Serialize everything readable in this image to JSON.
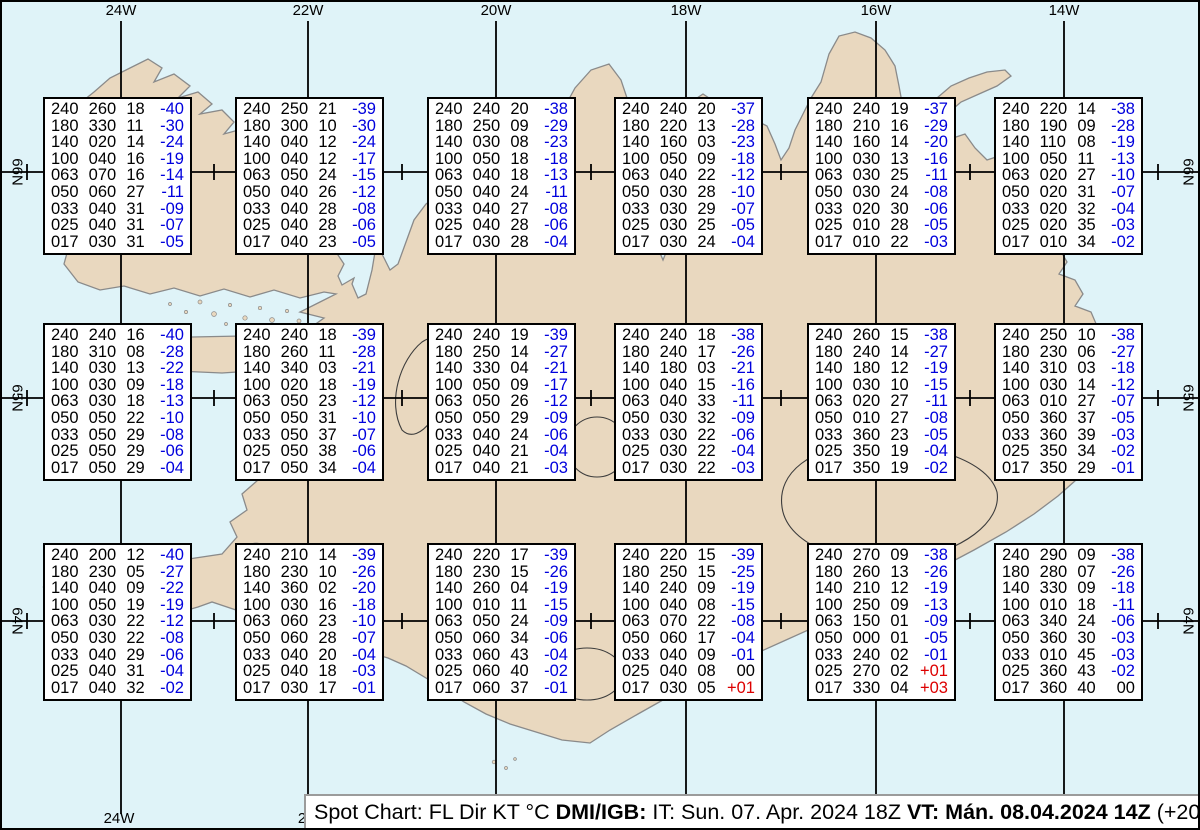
{
  "colors": {
    "sea": "#dff3f8",
    "land": "#e9d8bf",
    "coast": "#8a8a8a",
    "grid": "#000000",
    "temp_negative": "#0000dd",
    "temp_positive": "#dd0000",
    "text": "#000000"
  },
  "grid": {
    "lon_lines": [
      {
        "label": "24W",
        "x": 119
      },
      {
        "label": "22W",
        "x": 306
      },
      {
        "label": "20W",
        "x": 494
      },
      {
        "label": "18W",
        "x": 684
      },
      {
        "label": "16W",
        "x": 874
      },
      {
        "label": "14W",
        "x": 1062
      }
    ],
    "lat_lines": [
      {
        "label": "66N",
        "y": 170
      },
      {
        "label": "65N",
        "y": 396
      },
      {
        "label": "64N",
        "y": 619
      }
    ],
    "minor_tick_xs": [
      25,
      212,
      400,
      589,
      779,
      968,
      1156
    ],
    "bottom_labels": [
      {
        "text": "24W",
        "x": 117
      },
      {
        "text": "2",
        "x": 300
      }
    ],
    "lat_label_left_x": 15,
    "lat_label_right_x": 1186
  },
  "stations": [
    {
      "x": 41,
      "y": 95,
      "rows": [
        [
          "240",
          "260",
          "18",
          "-40"
        ],
        [
          "180",
          "330",
          "11",
          "-30"
        ],
        [
          "140",
          "020",
          "14",
          "-24"
        ],
        [
          "100",
          "040",
          "16",
          "-19"
        ],
        [
          "063",
          "070",
          "16",
          "-14"
        ],
        [
          "050",
          "060",
          "27",
          "-11"
        ],
        [
          "033",
          "040",
          "31",
          "-09"
        ],
        [
          "025",
          "040",
          "31",
          "-07"
        ],
        [
          "017",
          "030",
          "31",
          "-05"
        ]
      ]
    },
    {
      "x": 233,
      "y": 95,
      "rows": [
        [
          "240",
          "250",
          "21",
          "-39"
        ],
        [
          "180",
          "300",
          "10",
          "-30"
        ],
        [
          "140",
          "040",
          "12",
          "-24"
        ],
        [
          "100",
          "040",
          "12",
          "-17"
        ],
        [
          "063",
          "050",
          "24",
          "-15"
        ],
        [
          "050",
          "040",
          "26",
          "-12"
        ],
        [
          "033",
          "040",
          "28",
          "-08"
        ],
        [
          "025",
          "040",
          "28",
          "-06"
        ],
        [
          "017",
          "040",
          "23",
          "-05"
        ]
      ]
    },
    {
      "x": 425,
      "y": 95,
      "rows": [
        [
          "240",
          "240",
          "20",
          "-38"
        ],
        [
          "180",
          "250",
          "09",
          "-29"
        ],
        [
          "140",
          "030",
          "08",
          "-23"
        ],
        [
          "100",
          "050",
          "18",
          "-18"
        ],
        [
          "063",
          "040",
          "18",
          "-13"
        ],
        [
          "050",
          "040",
          "24",
          "-11"
        ],
        [
          "033",
          "040",
          "27",
          "-08"
        ],
        [
          "025",
          "040",
          "28",
          "-06"
        ],
        [
          "017",
          "030",
          "28",
          "-04"
        ]
      ]
    },
    {
      "x": 612,
      "y": 95,
      "rows": [
        [
          "240",
          "240",
          "20",
          "-37"
        ],
        [
          "180",
          "220",
          "13",
          "-28"
        ],
        [
          "140",
          "160",
          "03",
          "-23"
        ],
        [
          "100",
          "050",
          "09",
          "-18"
        ],
        [
          "063",
          "040",
          "22",
          "-12"
        ],
        [
          "050",
          "030",
          "28",
          "-10"
        ],
        [
          "033",
          "030",
          "29",
          "-07"
        ],
        [
          "025",
          "030",
          "25",
          "-05"
        ],
        [
          "017",
          "030",
          "24",
          "-04"
        ]
      ]
    },
    {
      "x": 805,
      "y": 95,
      "rows": [
        [
          "240",
          "240",
          "19",
          "-37"
        ],
        [
          "180",
          "210",
          "16",
          "-29"
        ],
        [
          "140",
          "160",
          "14",
          "-20"
        ],
        [
          "100",
          "030",
          "13",
          "-16"
        ],
        [
          "063",
          "030",
          "25",
          "-11"
        ],
        [
          "050",
          "030",
          "24",
          "-08"
        ],
        [
          "033",
          "020",
          "30",
          "-06"
        ],
        [
          "025",
          "010",
          "28",
          "-05"
        ],
        [
          "017",
          "010",
          "22",
          "-03"
        ]
      ]
    },
    {
      "x": 992,
      "y": 95,
      "rows": [
        [
          "240",
          "220",
          "14",
          "-38"
        ],
        [
          "180",
          "190",
          "09",
          "-28"
        ],
        [
          "140",
          "110",
          "08",
          "-19"
        ],
        [
          "100",
          "050",
          "11",
          "-13"
        ],
        [
          "063",
          "020",
          "27",
          "-10"
        ],
        [
          "050",
          "020",
          "31",
          "-07"
        ],
        [
          "033",
          "020",
          "32",
          "-04"
        ],
        [
          "025",
          "020",
          "35",
          "-03"
        ],
        [
          "017",
          "010",
          "34",
          "-02"
        ]
      ]
    },
    {
      "x": 41,
      "y": 321,
      "rows": [
        [
          "240",
          "240",
          "16",
          "-40"
        ],
        [
          "180",
          "310",
          "08",
          "-28"
        ],
        [
          "140",
          "030",
          "13",
          "-22"
        ],
        [
          "100",
          "030",
          "09",
          "-18"
        ],
        [
          "063",
          "030",
          "18",
          "-13"
        ],
        [
          "050",
          "050",
          "22",
          "-10"
        ],
        [
          "033",
          "050",
          "29",
          "-08"
        ],
        [
          "025",
          "050",
          "29",
          "-06"
        ],
        [
          "017",
          "050",
          "29",
          "-04"
        ]
      ]
    },
    {
      "x": 233,
      "y": 321,
      "rows": [
        [
          "240",
          "240",
          "18",
          "-39"
        ],
        [
          "180",
          "260",
          "11",
          "-28"
        ],
        [
          "140",
          "340",
          "03",
          "-21"
        ],
        [
          "100",
          "020",
          "18",
          "-19"
        ],
        [
          "063",
          "050",
          "23",
          "-12"
        ],
        [
          "050",
          "050",
          "31",
          "-10"
        ],
        [
          "033",
          "050",
          "37",
          "-07"
        ],
        [
          "025",
          "050",
          "38",
          "-06"
        ],
        [
          "017",
          "050",
          "34",
          "-04"
        ]
      ]
    },
    {
      "x": 425,
      "y": 321,
      "rows": [
        [
          "240",
          "240",
          "19",
          "-39"
        ],
        [
          "180",
          "250",
          "14",
          "-27"
        ],
        [
          "140",
          "330",
          "04",
          "-21"
        ],
        [
          "100",
          "050",
          "09",
          "-17"
        ],
        [
          "063",
          "050",
          "26",
          "-12"
        ],
        [
          "050",
          "050",
          "29",
          "-09"
        ],
        [
          "033",
          "040",
          "24",
          "-06"
        ],
        [
          "025",
          "040",
          "21",
          "-04"
        ],
        [
          "017",
          "040",
          "21",
          "-03"
        ]
      ]
    },
    {
      "x": 612,
      "y": 321,
      "rows": [
        [
          "240",
          "240",
          "18",
          "-38"
        ],
        [
          "180",
          "240",
          "17",
          "-26"
        ],
        [
          "140",
          "180",
          "03",
          "-21"
        ],
        [
          "100",
          "040",
          "15",
          "-16"
        ],
        [
          "063",
          "040",
          "33",
          "-11"
        ],
        [
          "050",
          "030",
          "32",
          "-09"
        ],
        [
          "033",
          "030",
          "22",
          "-06"
        ],
        [
          "025",
          "030",
          "22",
          "-04"
        ],
        [
          "017",
          "030",
          "22",
          "-03"
        ]
      ]
    },
    {
      "x": 805,
      "y": 321,
      "rows": [
        [
          "240",
          "260",
          "15",
          "-38"
        ],
        [
          "180",
          "240",
          "14",
          "-27"
        ],
        [
          "140",
          "180",
          "12",
          "-19"
        ],
        [
          "100",
          "030",
          "10",
          "-15"
        ],
        [
          "063",
          "020",
          "27",
          "-11"
        ],
        [
          "050",
          "010",
          "27",
          "-08"
        ],
        [
          "033",
          "360",
          "23",
          "-05"
        ],
        [
          "025",
          "350",
          "19",
          "-04"
        ],
        [
          "017",
          "350",
          "19",
          "-02"
        ]
      ]
    },
    {
      "x": 992,
      "y": 321,
      "rows": [
        [
          "240",
          "250",
          "10",
          "-38"
        ],
        [
          "180",
          "230",
          "06",
          "-27"
        ],
        [
          "140",
          "310",
          "03",
          "-18"
        ],
        [
          "100",
          "030",
          "14",
          "-12"
        ],
        [
          "063",
          "010",
          "27",
          "-07"
        ],
        [
          "050",
          "360",
          "37",
          "-05"
        ],
        [
          "033",
          "360",
          "39",
          "-03"
        ],
        [
          "025",
          "350",
          "34",
          "-02"
        ],
        [
          "017",
          "350",
          "29",
          "-01"
        ]
      ]
    },
    {
      "x": 41,
      "y": 541,
      "rows": [
        [
          "240",
          "200",
          "12",
          "-40"
        ],
        [
          "180",
          "230",
          "05",
          "-27"
        ],
        [
          "140",
          "040",
          "09",
          "-22"
        ],
        [
          "100",
          "050",
          "19",
          "-19"
        ],
        [
          "063",
          "030",
          "22",
          "-12"
        ],
        [
          "050",
          "030",
          "22",
          "-08"
        ],
        [
          "033",
          "040",
          "29",
          "-06"
        ],
        [
          "025",
          "040",
          "31",
          "-04"
        ],
        [
          "017",
          "040",
          "32",
          "-02"
        ]
      ]
    },
    {
      "x": 233,
      "y": 541,
      "rows": [
        [
          "240",
          "210",
          "14",
          "-39"
        ],
        [
          "180",
          "230",
          "10",
          "-26"
        ],
        [
          "140",
          "360",
          "02",
          "-20"
        ],
        [
          "100",
          "030",
          "16",
          "-18"
        ],
        [
          "063",
          "060",
          "23",
          "-10"
        ],
        [
          "050",
          "060",
          "28",
          "-07"
        ],
        [
          "033",
          "040",
          "20",
          "-04"
        ],
        [
          "025",
          "040",
          "18",
          "-03"
        ],
        [
          "017",
          "030",
          "17",
          "-01"
        ]
      ]
    },
    {
      "x": 425,
      "y": 541,
      "rows": [
        [
          "240",
          "220",
          "17",
          "-39"
        ],
        [
          "180",
          "230",
          "15",
          "-26"
        ],
        [
          "140",
          "260",
          "04",
          "-19"
        ],
        [
          "100",
          "010",
          "11",
          "-15"
        ],
        [
          "063",
          "050",
          "24",
          "-09"
        ],
        [
          "050",
          "060",
          "34",
          "-06"
        ],
        [
          "033",
          "060",
          "43",
          "-04"
        ],
        [
          "025",
          "060",
          "40",
          "-02"
        ],
        [
          "017",
          "060",
          "37",
          "-01"
        ]
      ]
    },
    {
      "x": 612,
      "y": 541,
      "rows": [
        [
          "240",
          "220",
          "15",
          "-39"
        ],
        [
          "180",
          "250",
          "15",
          "-25"
        ],
        [
          "140",
          "240",
          "09",
          "-19"
        ],
        [
          "100",
          "040",
          "08",
          "-15"
        ],
        [
          "063",
          "070",
          "22",
          "-08"
        ],
        [
          "050",
          "060",
          "17",
          "-04"
        ],
        [
          "033",
          "040",
          "09",
          "-01"
        ],
        [
          "025",
          "040",
          "08",
          "00"
        ],
        [
          "017",
          "030",
          "05",
          "+01"
        ]
      ]
    },
    {
      "x": 805,
      "y": 541,
      "rows": [
        [
          "240",
          "270",
          "09",
          "-38"
        ],
        [
          "180",
          "260",
          "13",
          "-26"
        ],
        [
          "140",
          "210",
          "12",
          "-19"
        ],
        [
          "100",
          "250",
          "09",
          "-13"
        ],
        [
          "063",
          "150",
          "01",
          "-09"
        ],
        [
          "050",
          "000",
          "01",
          "-05"
        ],
        [
          "033",
          "240",
          "02",
          "-01"
        ],
        [
          "025",
          "270",
          "02",
          "+01"
        ],
        [
          "017",
          "330",
          "04",
          "+03"
        ]
      ]
    },
    {
      "x": 992,
      "y": 541,
      "rows": [
        [
          "240",
          "290",
          "09",
          "-38"
        ],
        [
          "180",
          "280",
          "07",
          "-26"
        ],
        [
          "140",
          "330",
          "09",
          "-18"
        ],
        [
          "100",
          "010",
          "18",
          "-11"
        ],
        [
          "063",
          "340",
          "24",
          "-06"
        ],
        [
          "050",
          "360",
          "30",
          "-03"
        ],
        [
          "033",
          "010",
          "45",
          "-03"
        ],
        [
          "025",
          "360",
          "43",
          "-02"
        ],
        [
          "017",
          "360",
          "40",
          "00"
        ]
      ]
    }
  ],
  "title_bar": {
    "segments": [
      {
        "text": "Spot Chart: FL Dir KT °C ",
        "bold": false
      },
      {
        "text": "DMI/IGB:",
        "bold": true
      },
      {
        "text": " IT: Sun. 07. Apr. 2024 18Z ",
        "bold": false
      },
      {
        "text": "VT: Mán. 08.04.2024 14Z",
        "bold": true
      },
      {
        "text": " (+20 h)",
        "bold": false
      }
    ]
  }
}
